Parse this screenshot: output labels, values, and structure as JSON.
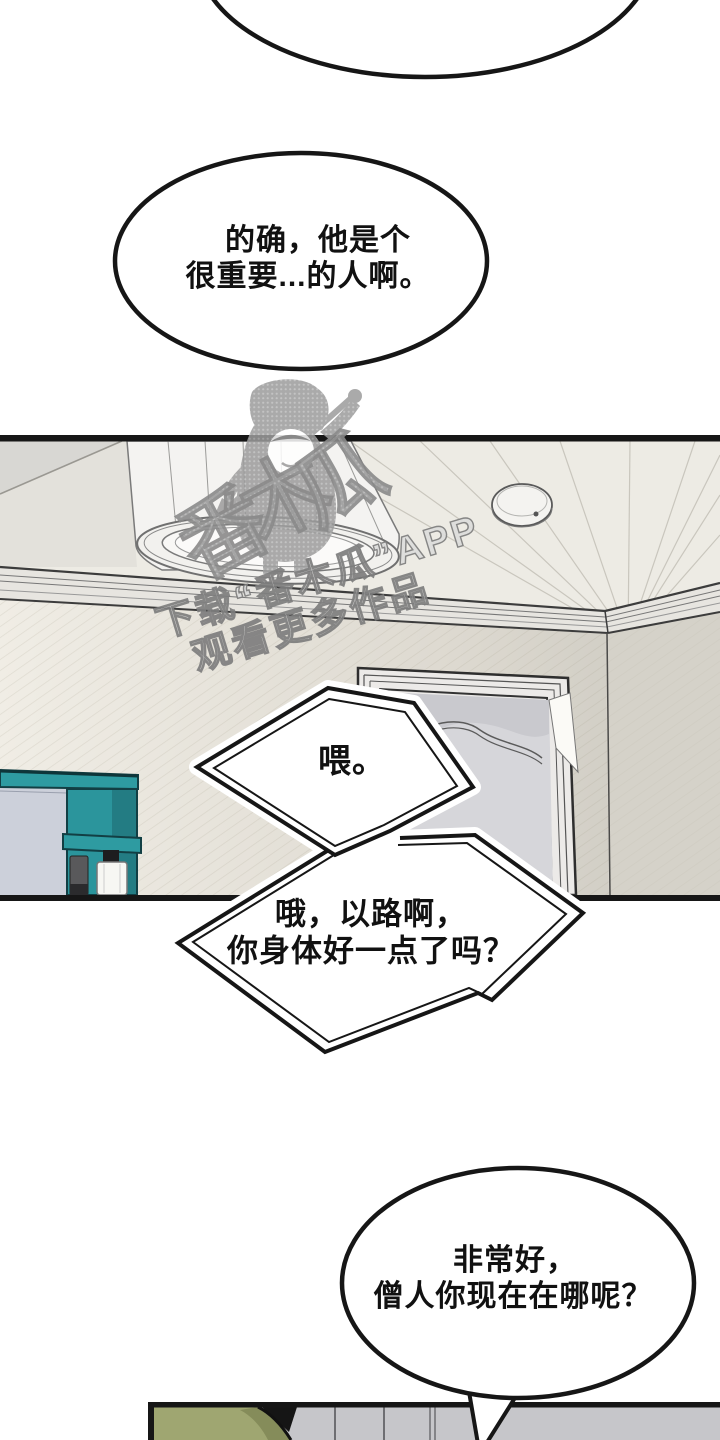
{
  "bubbles": {
    "b1": {
      "line1": "的确，他是个",
      "line2": "很重要...的人啊。"
    },
    "b2": {
      "line1": "喂。"
    },
    "b3": {
      "line1": "哦，以路啊，",
      "line2": "你身体好一点了吗？"
    },
    "b4": {
      "line1": "非常好，",
      "line2": "僧人你现在在哪呢？"
    }
  },
  "watermark": {
    "brand_characters": [
      "番",
      "木",
      "瓜"
    ],
    "tagline_line1": "下载“番木瓜”APP",
    "tagline_line2": "观看更多作品"
  },
  "colors": {
    "cabinet_teal": "#2b979e",
    "mirror_gray": "#ccd0da",
    "hair_olive": "#9fa671",
    "bottom_wall_gray": "#c6c6ca",
    "line_black": "#161616"
  }
}
